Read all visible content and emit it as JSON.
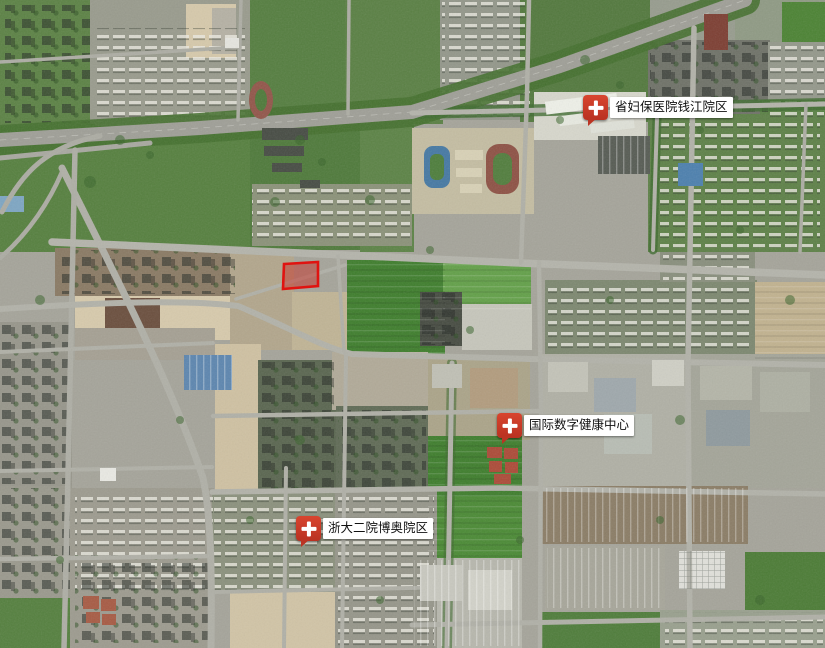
{
  "map": {
    "view_type": "satellite imagery",
    "markers": [
      {
        "label": "省妇保医院钱江院区",
        "icon": "red-plus-pin-icon"
      },
      {
        "label": "国际数字健康中心",
        "icon": "red-plus-pin-icon"
      },
      {
        "label": "浙大二院博奥院区",
        "icon": "red-plus-pin-icon"
      }
    ],
    "selected_plot": {
      "points": "284,264 318,262 318,286 283,289",
      "fill": "rgba(201,38,28,0.45)",
      "stroke": "#e01310"
    },
    "colors": {
      "marker_red": "#cf3a2a",
      "label_background": "#ffffff",
      "label_text": "#111111",
      "plot_outline_red": "#e01310"
    }
  }
}
